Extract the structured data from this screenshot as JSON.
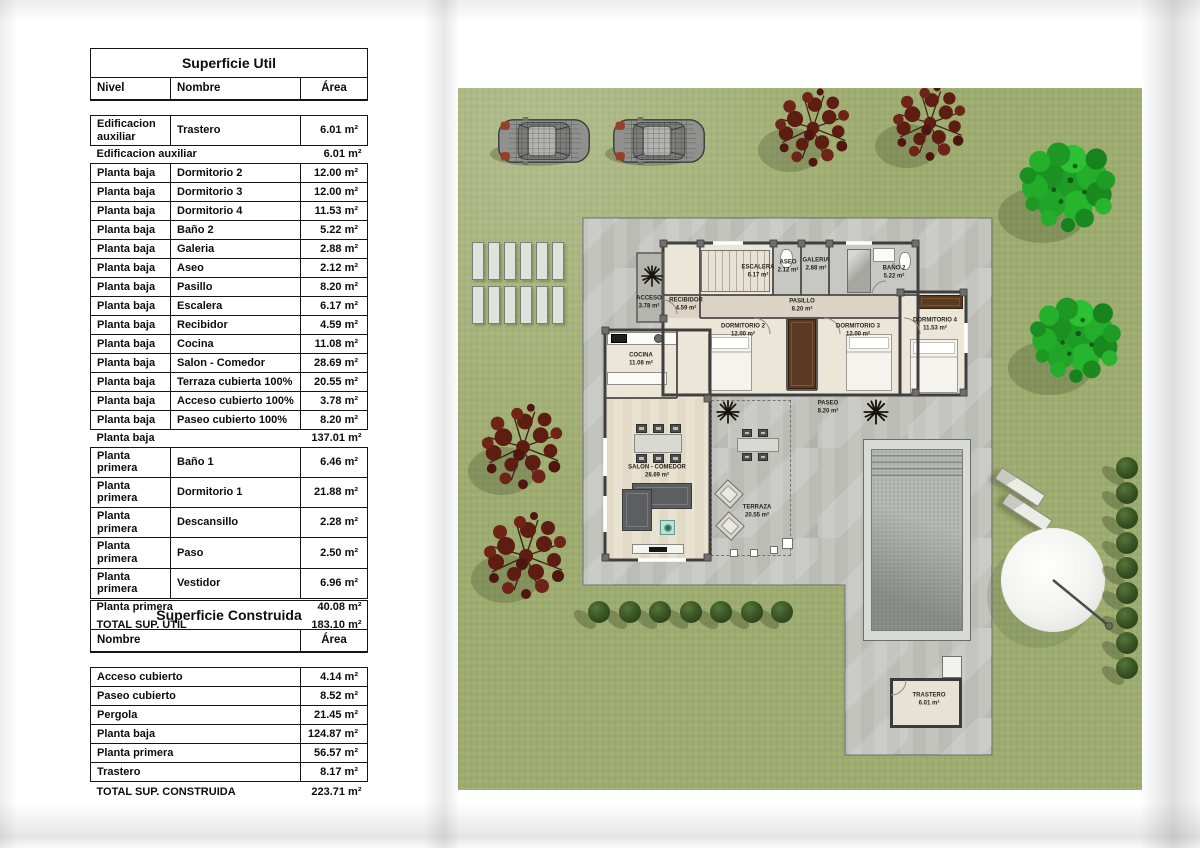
{
  "tables": {
    "superficie_util": {
      "title": "Superficie Util",
      "columns": [
        "Nivel",
        "Nombre",
        "Área"
      ],
      "rows": [
        {
          "type": "data",
          "cells": [
            "Edificacion auxiliar",
            "Trastero",
            "6.01 m²"
          ]
        },
        {
          "type": "subtotal",
          "cells": [
            "Edificacion auxiliar",
            "6.01 m²"
          ]
        },
        {
          "type": "data",
          "cells": [
            "Planta baja",
            "Dormitorio 2",
            "12.00 m²"
          ]
        },
        {
          "type": "data",
          "cells": [
            "Planta baja",
            "Dormitorio 3",
            "12.00 m²"
          ]
        },
        {
          "type": "data",
          "cells": [
            "Planta baja",
            "Dormitorio 4",
            "11.53 m²"
          ]
        },
        {
          "type": "data",
          "cells": [
            "Planta baja",
            "Baño 2",
            "5.22 m²"
          ]
        },
        {
          "type": "data",
          "cells": [
            "Planta baja",
            "Galeria",
            "2.88 m²"
          ]
        },
        {
          "type": "data",
          "cells": [
            "Planta baja",
            "Aseo",
            "2.12 m²"
          ]
        },
        {
          "type": "data",
          "cells": [
            "Planta baja",
            "Pasillo",
            "8.20 m²"
          ]
        },
        {
          "type": "data",
          "cells": [
            "Planta baja",
            "Escalera",
            "6.17 m²"
          ]
        },
        {
          "type": "data",
          "cells": [
            "Planta baja",
            "Recibidor",
            "4.59 m²"
          ]
        },
        {
          "type": "data",
          "cells": [
            "Planta baja",
            "Cocina",
            "11.08 m²"
          ]
        },
        {
          "type": "data",
          "cells": [
            "Planta baja",
            "Salon - Comedor",
            "28.69 m²"
          ]
        },
        {
          "type": "data",
          "cells": [
            "Planta baja",
            "Terraza cubierta 100%",
            "20.55 m²"
          ]
        },
        {
          "type": "data",
          "cells": [
            "Planta baja",
            "Acceso cubierto 100%",
            "3.78 m²"
          ]
        },
        {
          "type": "data",
          "cells": [
            "Planta baja",
            "Paseo cubierto 100%",
            "8.20 m²"
          ]
        },
        {
          "type": "subtotal",
          "cells": [
            "Planta baja",
            "137.01 m²"
          ]
        },
        {
          "type": "data",
          "cells": [
            "Planta primera",
            "Baño 1",
            "6.46 m²"
          ]
        },
        {
          "type": "data",
          "cells": [
            "Planta primera",
            "Dormitorio 1",
            "21.88 m²"
          ]
        },
        {
          "type": "data",
          "cells": [
            "Planta primera",
            "Descansillo",
            "2.28 m²"
          ]
        },
        {
          "type": "data",
          "cells": [
            "Planta primera",
            "Paso",
            "2.50 m²"
          ]
        },
        {
          "type": "data",
          "cells": [
            "Planta primera",
            "Vestidor",
            "6.96 m²"
          ]
        },
        {
          "type": "subtotal",
          "cells": [
            "Planta primera",
            "40.08 m²"
          ]
        },
        {
          "type": "total",
          "cells": [
            "TOTAL SUP. UTIL",
            "183.10 m²"
          ]
        }
      ]
    },
    "superficie_construida": {
      "title": "Superficie Construida",
      "columns": [
        "Nombre",
        "Área"
      ],
      "rows": [
        {
          "type": "data",
          "cells": [
            "Acceso cubierto",
            "4.14 m²"
          ]
        },
        {
          "type": "data",
          "cells": [
            "Paseo cubierto",
            "8.52 m²"
          ]
        },
        {
          "type": "data",
          "cells": [
            "Pergola",
            "21.45 m²"
          ]
        },
        {
          "type": "data",
          "cells": [
            "Planta baja",
            "124.87 m²"
          ]
        },
        {
          "type": "data",
          "cells": [
            "Planta primera",
            "56.57 m²"
          ]
        },
        {
          "type": "data",
          "cells": [
            "Trastero",
            "8.17 m²"
          ]
        },
        {
          "type": "total",
          "cells": [
            "TOTAL SUP. CONSTRUIDA",
            "223.71 m²"
          ]
        }
      ]
    }
  },
  "plan": {
    "labels": [
      {
        "label": "ACCESO",
        "area": "3.78 m²",
        "x": 191,
        "y": 215
      },
      {
        "label": "RECIBIDOR",
        "area": "4.59 m²",
        "x": 228,
        "y": 217
      },
      {
        "label": "ESCALERA",
        "area": "6.17 m²",
        "x": 300,
        "y": 184
      },
      {
        "label": "ASEO",
        "area": "2.12 m²",
        "x": 330,
        "y": 179
      },
      {
        "label": "GALERIA",
        "area": "2.88 m²",
        "x": 358,
        "y": 177
      },
      {
        "label": "BAÑO 2",
        "area": "5.22 m²",
        "x": 436,
        "y": 185
      },
      {
        "label": "PASILLO",
        "area": "8.20 m²",
        "x": 344,
        "y": 218
      },
      {
        "label": "DORMITORIO 2",
        "area": "12.00 m²",
        "x": 285,
        "y": 243
      },
      {
        "label": "DORMITORIO 3",
        "area": "12.00 m²",
        "x": 400,
        "y": 243
      },
      {
        "label": "DORMITORIO 4",
        "area": "11.53 m²",
        "x": 477,
        "y": 237
      },
      {
        "label": "COCINA",
        "area": "11.08 m²",
        "x": 183,
        "y": 272
      },
      {
        "label": "SALON - COMEDOR",
        "area": "28.69 m²",
        "x": 199,
        "y": 384
      },
      {
        "label": "TERRAZA",
        "area": "20.55 m²",
        "x": 299,
        "y": 424
      },
      {
        "label": "PASEO",
        "area": "8.20 m²",
        "x": 370,
        "y": 320
      },
      {
        "label": "TRASTERO",
        "area": "6.01 m²",
        "x": 471,
        "y": 612
      }
    ],
    "colors": {
      "grass": "#9dac6e",
      "deck": "#c1c1bc",
      "floor": "#ebe6d8",
      "pool_water": "#b4b8b4",
      "red_tree": "#5e1d13",
      "green_tree": "#23a32a",
      "bush": "#2f4a22",
      "wardrobe": "#5a3a22"
    }
  }
}
